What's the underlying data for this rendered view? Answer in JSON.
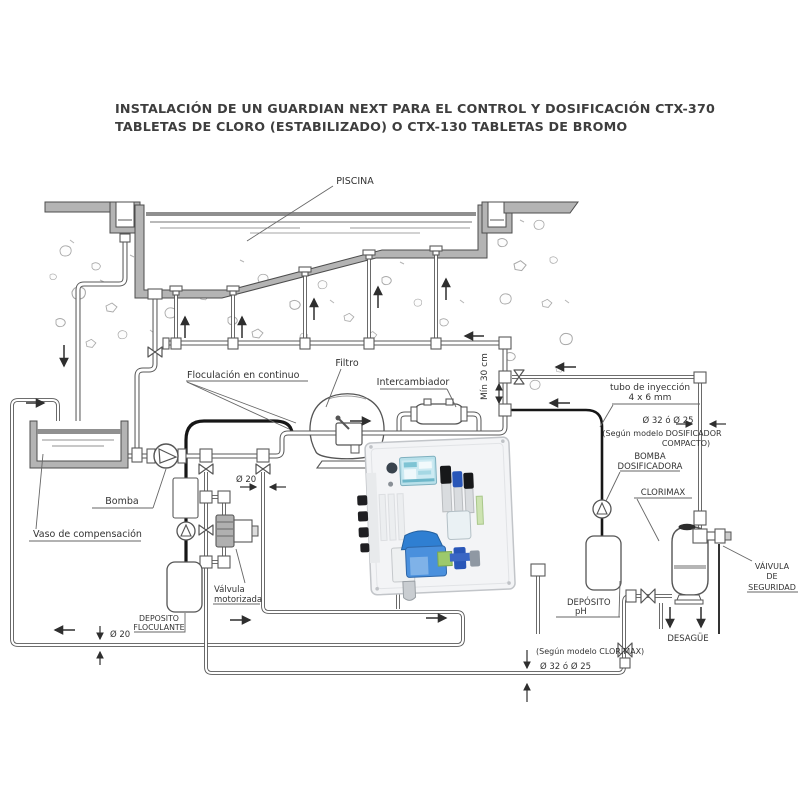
{
  "title": {
    "line1": "INSTALACIÓN DE UN GUARDIAN NEXT PARA EL CONTROL Y DOSIFICACIÓN CTX-370",
    "line2": "TABLETAS DE CLORO (ESTABILIZADO) O CTX-130 TABLETAS DE BROMO"
  },
  "labels": {
    "piscina": "PISCINA",
    "floculacion": "Floculación en continuo",
    "filtro": "Filtro",
    "intercambiador": "Intercambiador",
    "min_30_cm": "Mín 30 cm",
    "tubo_inyeccion_l1": "tubo de inyección",
    "tubo_inyeccion_l2": "4 x 6 mm",
    "diam_32_right": "Ø 32 ó Ø 25",
    "segun_dosificador_l1": "(Según modelo DOSIFICADOR",
    "segun_dosificador_l2": "COMPACTO)",
    "bomba_dosificadora_l1": "BOMBA",
    "bomba_dosificadora_l2": "DOSIFICADORA",
    "clorimax": "CLORIMAX",
    "valvula_seguridad_l1": "VÁIVULA",
    "valvula_seguridad_l2": "DE",
    "valvula_seguridad_l3": "SEGURIDAD",
    "deposito_ph_l1": "DEPÓSITO",
    "deposito_ph_l2": "pH",
    "desague": "DESAGÜE",
    "segun_clorimax": "(Según modelo CLORIMAX)",
    "diam_32_bottom": "Ø 32 ó Ø 25",
    "diam_20_bottom": "Ø 20",
    "diam_20_mid": "Ø 20",
    "bomba": "Bomba",
    "vaso_compensacion": "Vaso de compensación",
    "deposito_floculante_l1": "DEPOSITO",
    "deposito_floculante_l2": "FLOCULANTE",
    "valvula_motorizada_l1": "Válvula",
    "valvula_motorizada_l2": "motorizada"
  },
  "colors": {
    "line_work": "#5a5a5a",
    "concrete": "#b4b4b4",
    "black_tube": "#161616",
    "device_screen": "#b8e0ea",
    "device_blue": "#4a90dd",
    "text": "#333333"
  }
}
